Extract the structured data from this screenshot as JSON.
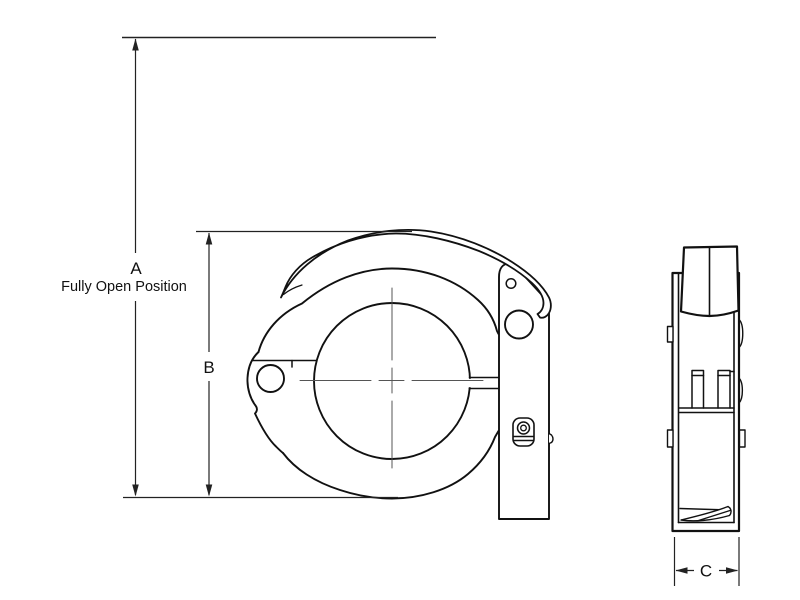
{
  "drawing": {
    "labels": {
      "dim_a": "A",
      "dim_a_note": "Fully Open Position",
      "dim_b": "B",
      "dim_c": "C"
    },
    "colors": {
      "line": "#111111",
      "dimension_line": "#222222",
      "centerline": "#555555",
      "background": "#ffffff"
    }
  }
}
